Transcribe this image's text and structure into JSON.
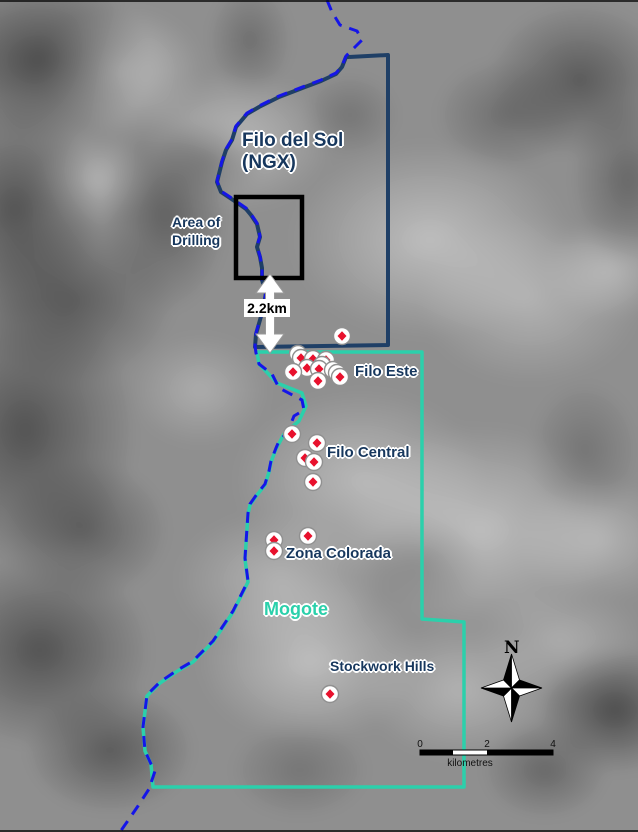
{
  "map": {
    "labels": {
      "property_title_line1": "Filo del Sol",
      "property_title_line2": "(NGX)",
      "area_of_drilling_line1": "Area of",
      "area_of_drilling_line2": "Drilling",
      "distance": "2.2km",
      "filo_este": "Filo Este",
      "filo_central": "Filo Central",
      "zona_colorada": "Zona Colorada",
      "mogote": "Mogote",
      "stockwork_hills": "Stockwork Hills",
      "north": "N"
    },
    "scale_bar": {
      "tick_0": "0",
      "tick_2": "2",
      "tick_4": "4",
      "units": "kilometres"
    },
    "colors": {
      "ngx_boundary": "#1f3f66",
      "mogote_boundary": "#2bd0ab",
      "international_border": "#1515e8",
      "drill_marker_fill": "#e8112d",
      "drill_marker_ring": "#909090",
      "annotation_box": "#000000",
      "distance_arrow": "#ffffff",
      "label_navy": "#17375d"
    },
    "geometry": {
      "border_dashed": [
        [
          327,
          0
        ],
        [
          332,
          12
        ],
        [
          340,
          25
        ],
        [
          357,
          31
        ],
        [
          362,
          40
        ],
        [
          355,
          47
        ],
        [
          346,
          56
        ],
        [
          342,
          66
        ],
        [
          336,
          73
        ],
        [
          321,
          80
        ],
        [
          305,
          86
        ],
        [
          279,
          96
        ],
        [
          259,
          106
        ],
        [
          247,
          113
        ],
        [
          236,
          126
        ],
        [
          232,
          139
        ],
        [
          226,
          149
        ],
        [
          222,
          161
        ],
        [
          219,
          173
        ],
        [
          217,
          181
        ],
        [
          221,
          191
        ],
        [
          236,
          201
        ],
        [
          246,
          208
        ],
        [
          251,
          214
        ],
        [
          257,
          223
        ],
        [
          260,
          236
        ],
        [
          257,
          246
        ],
        [
          260,
          256
        ],
        [
          262,
          267
        ],
        [
          262,
          279
        ],
        [
          266,
          291
        ],
        [
          264,
          304
        ],
        [
          260,
          319
        ],
        [
          256,
          333
        ],
        [
          255,
          346
        ],
        [
          256,
          353
        ],
        [
          259,
          364
        ],
        [
          272,
          374
        ],
        [
          279,
          388
        ],
        [
          302,
          400
        ],
        [
          304,
          410
        ],
        [
          294,
          416
        ],
        [
          292,
          421
        ],
        [
          287,
          433
        ],
        [
          279,
          441
        ],
        [
          276,
          448
        ],
        [
          271,
          461
        ],
        [
          269,
          471
        ],
        [
          265,
          484
        ],
        [
          257,
          494
        ],
        [
          250,
          504
        ],
        [
          248,
          513
        ],
        [
          247,
          528
        ],
        [
          245,
          558
        ],
        [
          248,
          581
        ],
        [
          233,
          611
        ],
        [
          213,
          641
        ],
        [
          193,
          661
        ],
        [
          176,
          671
        ],
        [
          160,
          682
        ],
        [
          147,
          695
        ],
        [
          143,
          727
        ],
        [
          145,
          751
        ],
        [
          151,
          764
        ],
        [
          155,
          771
        ],
        [
          149,
          789
        ],
        [
          138,
          806
        ],
        [
          127,
          822
        ],
        [
          120,
          832
        ]
      ],
      "ngx_boundary": [
        [
          349,
          57
        ],
        [
          388,
          55
        ],
        [
          388,
          345
        ],
        [
          255,
          347
        ],
        [
          256,
          334
        ],
        [
          260,
          320
        ],
        [
          264,
          305
        ],
        [
          266,
          292
        ],
        [
          262,
          280
        ],
        [
          262,
          268
        ],
        [
          260,
          257
        ],
        [
          257,
          247
        ],
        [
          260,
          237
        ],
        [
          257,
          224
        ],
        [
          251,
          215
        ],
        [
          246,
          209
        ],
        [
          236,
          202
        ],
        [
          221,
          192
        ],
        [
          217,
          182
        ],
        [
          219,
          174
        ],
        [
          222,
          162
        ],
        [
          226,
          150
        ],
        [
          232,
          140
        ],
        [
          236,
          127
        ],
        [
          247,
          114
        ],
        [
          259,
          107
        ],
        [
          279,
          97
        ],
        [
          305,
          87
        ],
        [
          321,
          81
        ],
        [
          336,
          74
        ],
        [
          342,
          67
        ],
        [
          346,
          57
        ],
        [
          349,
          57
        ]
      ],
      "mogote_boundary": [
        [
          257,
          352
        ],
        [
          422,
          352
        ],
        [
          422,
          619
        ],
        [
          464,
          622
        ],
        [
          464,
          787
        ],
        [
          153,
          787
        ],
        [
          151,
          764
        ],
        [
          145,
          751
        ],
        [
          143,
          727
        ],
        [
          147,
          696
        ],
        [
          160,
          683
        ],
        [
          176,
          672
        ],
        [
          193,
          662
        ],
        [
          213,
          642
        ],
        [
          233,
          612
        ],
        [
          248,
          582
        ],
        [
          245,
          559
        ],
        [
          247,
          529
        ],
        [
          248,
          514
        ],
        [
          250,
          505
        ],
        [
          257,
          495
        ],
        [
          265,
          485
        ],
        [
          269,
          472
        ],
        [
          271,
          462
        ],
        [
          276,
          449
        ],
        [
          284,
          434
        ],
        [
          287,
          431
        ],
        [
          299,
          421
        ],
        [
          306,
          406
        ],
        [
          302,
          393
        ],
        [
          277,
          383
        ],
        [
          259,
          364
        ],
        [
          257,
          352
        ]
      ],
      "area_of_drilling_box": {
        "x": 236,
        "y": 197,
        "w": 66,
        "h": 81
      },
      "drill_points": [
        [
          342,
          336
        ],
        [
          298,
          354
        ],
        [
          301,
          358
        ],
        [
          313,
          359
        ],
        [
          326,
          360
        ],
        [
          322,
          365
        ],
        [
          307,
          368
        ],
        [
          319,
          369
        ],
        [
          333,
          370
        ],
        [
          293,
          372
        ],
        [
          337,
          373
        ],
        [
          340,
          377
        ],
        [
          318,
          381
        ],
        [
          292,
          434
        ],
        [
          317,
          443
        ],
        [
          305,
          458
        ],
        [
          314,
          462
        ],
        [
          313,
          482
        ],
        [
          308,
          536
        ],
        [
          274,
          540
        ],
        [
          274,
          551
        ],
        [
          330,
          694
        ]
      ]
    }
  }
}
